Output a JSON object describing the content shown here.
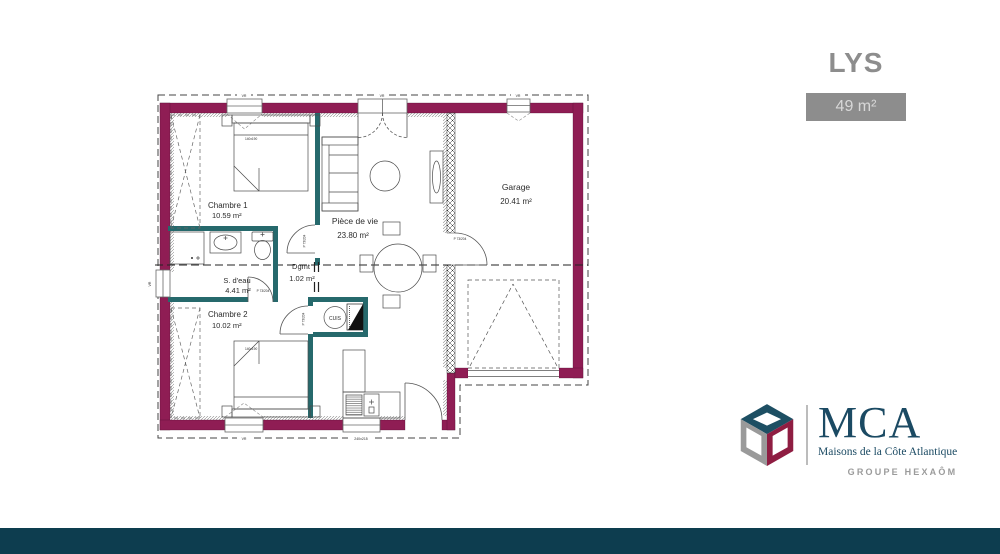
{
  "header": {
    "model_name": "LYS",
    "area_badge": "49 m²"
  },
  "plan": {
    "rooms": {
      "chambre1": {
        "name": "Chambre 1",
        "area": "10.59 m²"
      },
      "piece_de_vie": {
        "name": "Pièce de vie",
        "area": "23.80 m²"
      },
      "garage": {
        "name": "Garage",
        "area": "20.41 m²"
      },
      "sdeau": {
        "name": "S. d'eau",
        "area": "4.41 m²"
      },
      "dgmt": {
        "name": "Dgmt",
        "area": "1.02 m²"
      },
      "chambre2": {
        "name": "Chambre 2",
        "area": "10.02 m²"
      }
    },
    "kitchen_label": "CUIS",
    "door_label": "P 73/204",
    "bed_size_label": "140x190",
    "window_labels": {
      "top_left": "VR",
      "top_center": "VR",
      "top_garage": "VR",
      "bottom_left": "VR",
      "bottom_center": "240x215",
      "left": "VR"
    }
  },
  "branding": {
    "acronym": "MCA",
    "full_name": "Maisons de la Côte Atlantique",
    "group": "GROUPE HEXAÔM"
  },
  "colors": {
    "exterior_wall": "#8F1D54",
    "interior_wall": "#26696C",
    "footer_bar": "#0D3D4F",
    "brand_navy": "#1B4A63",
    "brand_gray": "#8D8D8D",
    "logo_red": "#8F1D42",
    "logo_teal": "#1D4F63",
    "logo_gray": "#9A9A9A"
  }
}
